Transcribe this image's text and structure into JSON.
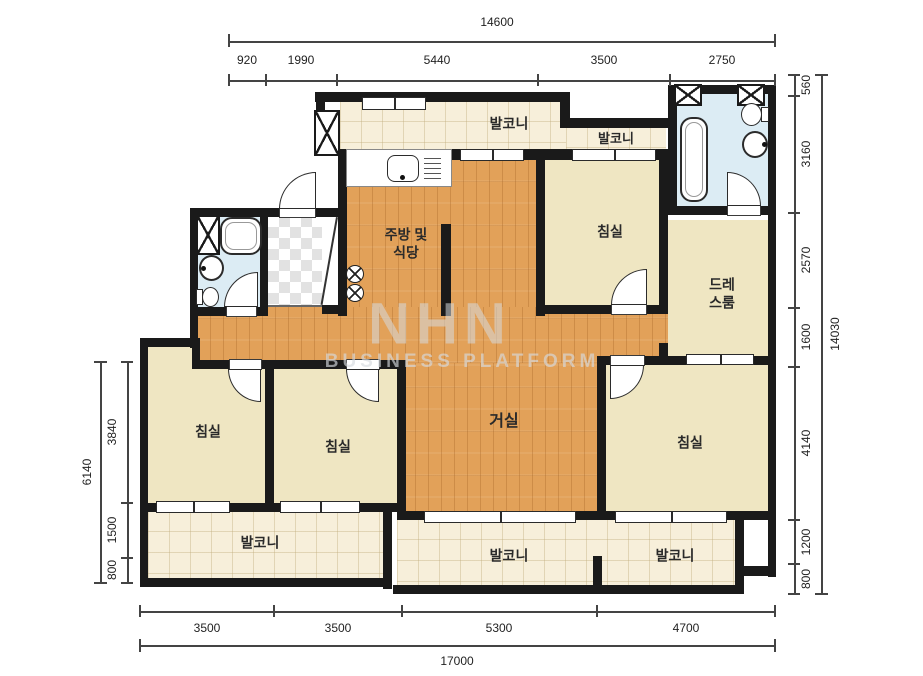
{
  "watermark": {
    "logo": "NHN",
    "subtitle": "BUSINESS PLATFORM"
  },
  "rooms": {
    "balcony_top_main": "발코니",
    "balcony_top_right": "발코니",
    "bedroom_top": "침실",
    "dressroom_line1": "드레",
    "dressroom_line2": "스룸",
    "kitchen_line1": "주방 및",
    "kitchen_line2": "식당",
    "living": "거실",
    "bedroom_left": "침실",
    "bedroom_mid": "침실",
    "bedroom_right": "침실",
    "balcony_bottom_left": "발코니",
    "balcony_bottom_mid": "발코니",
    "balcony_bottom_right": "발코니"
  },
  "dimensions": {
    "top": {
      "total": "14600",
      "segments": [
        "920",
        "1990",
        "5440",
        "3500",
        "2750"
      ]
    },
    "bottom": {
      "total": "17000",
      "segments": [
        "3500",
        "3500",
        "5300",
        "4700"
      ]
    },
    "left": {
      "total": "6140",
      "segments": [
        "3840",
        "1500",
        "800"
      ]
    },
    "right": {
      "total": "14030",
      "segments": [
        "560",
        "3160",
        "2570",
        "1600",
        "4140",
        "1200",
        "800"
      ]
    }
  },
  "colors": {
    "wall": "#1a1a1a",
    "wood_floor": "#e2a159",
    "bedroom_floor": "#efe6c2",
    "balcony_floor": "#f7efda",
    "bathroom_floor": "#dcecf4",
    "dimension_text": "#222222"
  }
}
